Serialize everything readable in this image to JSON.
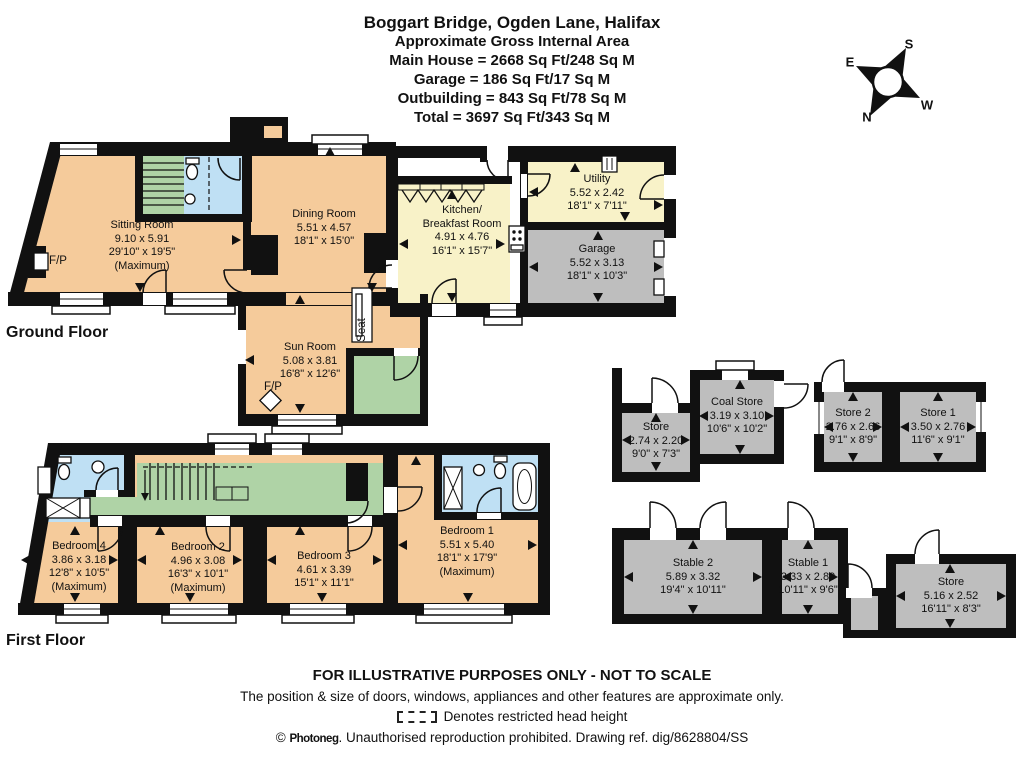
{
  "title": {
    "lines": [
      "Boggart Bridge, Ogden Lane, Halifax",
      "Approximate Gross Internal Area",
      "Main House = 2668 Sq Ft/248 Sq M",
      "Garage = 186 Sq Ft/17 Sq M",
      "Outbuilding = 843 Sq Ft/78 Sq M",
      "Total = 3697 Sq Ft/343 Sq M"
    ]
  },
  "compass": {
    "n": "N",
    "s": "S",
    "e": "E",
    "w": "W"
  },
  "floor_labels": {
    "ground": "Ground Floor",
    "first": "First Floor"
  },
  "annotations": {
    "fp": "F/P",
    "seat": "Seat"
  },
  "rooms": {
    "sitting": {
      "name": "Sitting Room",
      "metric": "9.10 x 5.91",
      "imperial": "29'10\" x 19'5\"",
      "note": "(Maximum)"
    },
    "dining": {
      "name": "Dining Room",
      "metric": "5.51 x 4.57",
      "imperial": "18'1\" x 15'0\""
    },
    "kitchen": {
      "name": "Kitchen/",
      "name2": "Breakfast Room",
      "metric": "4.91 x 4.76",
      "imperial": "16'1\" x 15'7\""
    },
    "utility": {
      "name": "Utility",
      "metric": "5.52 x 2.42",
      "imperial": "18'1\" x 7'11\""
    },
    "garage": {
      "name": "Garage",
      "metric": "5.52 x 3.13",
      "imperial": "18'1\" x 10'3\""
    },
    "sunroom": {
      "name": "Sun Room",
      "metric": "5.08 x 3.81",
      "imperial": "16'8\" x 12'6\""
    },
    "bedroom1": {
      "name": "Bedroom 1",
      "metric": "5.51 x 5.40",
      "imperial": "18'1\" x 17'9\"",
      "note": "(Maximum)"
    },
    "bedroom2": {
      "name": "Bedroom 2",
      "metric": "4.96 x 3.08",
      "imperial": "16'3\" x 10'1\"",
      "note": "(Maximum)"
    },
    "bedroom3": {
      "name": "Bedroom 3",
      "metric": "4.61 x 3.39",
      "imperial": "15'1\" x 11'1\""
    },
    "bedroom4": {
      "name": "Bedroom 4",
      "metric": "3.86 x 3.18",
      "imperial": "12'8\" x 10'5\"",
      "note": "(Maximum)"
    },
    "store_nw": {
      "name": "Store",
      "metric": "2.74 x 2.20",
      "imperial": "9'0\" x 7'3\""
    },
    "coal_store": {
      "name": "Coal Store",
      "metric": "3.19 x 3.10",
      "imperial": "10'6\" x 10'2\""
    },
    "store2": {
      "name": "Store 2",
      "metric": "2.76 x 2.66",
      "imperial": "9'1\" x 8'9\""
    },
    "store1": {
      "name": "Store 1",
      "metric": "3.50 x 2.76",
      "imperial": "11'6\" x 9'1\""
    },
    "stable2": {
      "name": "Stable 2",
      "metric": "5.89 x 3.32",
      "imperial": "19'4\" x 10'11\""
    },
    "stable1": {
      "name": "Stable 1",
      "metric": "3.33 x 2.89",
      "imperial": "10'11\" x 9'6\""
    },
    "store_e": {
      "name": "Store",
      "metric": "5.16 x 2.52",
      "imperial": "16'11\" x 8'3\""
    }
  },
  "footer": {
    "line1": "FOR ILLUSTRATIVE PURPOSES ONLY - NOT TO SCALE",
    "line2": "The position & size of doors, windows, appliances and other features are approximate only.",
    "line3": "Denotes restricted head height",
    "copyright": "©",
    "brand": "Photoneg",
    "line4rest": ". Unauthorised reproduction prohibited. Drawing ref. dig/8628804/SS"
  },
  "palette": {
    "room_peach": "#F5CB9B",
    "room_yellow": "#F8F2C8",
    "room_green": "#AFD3A6",
    "room_blue": "#BFE0F4",
    "room_gray": "#BEBEBE",
    "wall": "#111111"
  }
}
